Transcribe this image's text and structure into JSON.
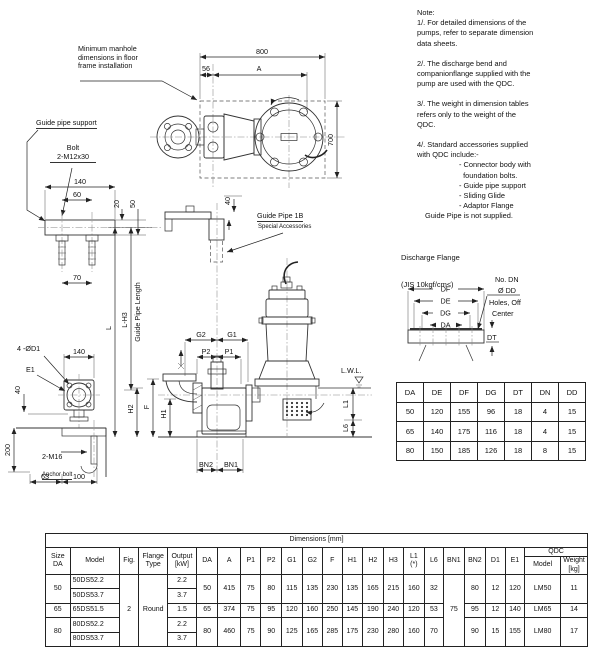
{
  "notes": {
    "items": [
      "Note:",
      "1/. For detailed dimensions of the\npumps, refer to separate dimension\ndata sheets.",
      "2/. The discharge bend and\ncompanionflange supplied with the\npump are used with the QDC.",
      "3/. The weight in dimension tables\nrefers only to the weight of the\nQDC.",
      "4/. Standard accessories supplied\nwith QDC include:-",
      "- Connector body with\n  foundation bolts.",
      "- Guide pipe support",
      "- Sliding Glide",
      "- Adaptor Flange",
      "Guide Pipe is not supplied."
    ]
  },
  "drawing": {
    "manhole_note": "Minimum manhole\ndimensions in floor\nframe installation",
    "guide_pipe_support": "Guide pipe support",
    "bolt": "Bolt\n2-M12x30",
    "gp1b": "Guide Pipe 1B",
    "special_acc": "Special Accessories",
    "d800": "800",
    "d56": "56",
    "dA": "A",
    "d700": "700",
    "d140_support": "140",
    "d60": "60",
    "d70": "70",
    "d20": "20",
    "d50": "50",
    "d40_pipe": "40",
    "L": "L",
    "LH3": "L-H3",
    "gpl": "Guide Pipe Length",
    "four_od1": "4 -ØD1",
    "e1": "E1",
    "d140_plate": "140",
    "d40_plate": "40",
    "d200": "200",
    "m16": "2-M16",
    "anchor_bolt": "Anchor bolt",
    "d63": "63",
    "d100": "100",
    "h2": "H2",
    "f": "F",
    "h1": "H1",
    "g2": "G2",
    "g1": "G1",
    "p2": "P2",
    "p1": "P1",
    "bn2": "BN2",
    "bn1": "BN1",
    "lwl": "L.W.L.",
    "l1": "L1",
    "l6": "L6"
  },
  "flange": {
    "title": "Discharge Flange",
    "subtitle": "(JIS 10kgf/cm≤)",
    "df": "DF",
    "de": "DE",
    "dg": "DG",
    "da": "DA",
    "dt": "DT",
    "hole_note_1": "No. DN",
    "hole_note_2": "Ø DD",
    "hole_note_3": "Holes, Off",
    "hole_note_4": "Center"
  },
  "flange_table": {
    "headers": [
      "DA",
      "DE",
      "DF",
      "DG",
      "DT",
      "DN",
      "DD"
    ],
    "rows": [
      [
        "50",
        "120",
        "155",
        "96",
        "18",
        "4",
        "15"
      ],
      [
        "65",
        "140",
        "175",
        "116",
        "18",
        "4",
        "15"
      ],
      [
        "80",
        "150",
        "185",
        "126",
        "18",
        "8",
        "15"
      ]
    ]
  },
  "main_table": {
    "title": "Dimensions [mm]",
    "col_headers": [
      "Size\nDA",
      "Model",
      "Fig.",
      "Flange\nType",
      "Output\n[kW]",
      "DA",
      "A",
      "P1",
      "P2",
      "G1",
      "G2",
      "F",
      "H1",
      "H2",
      "H3",
      "L1\n(*)",
      "L6",
      "BN1",
      "BN2",
      "D1",
      "E1"
    ],
    "qdc_label": "QDC",
    "qdc_model_header": "Model",
    "qdc_weight_header": "Weight\n[kg]",
    "fig": "2",
    "flange_type": "Round",
    "bn1": "75",
    "groups": [
      {
        "size": "50",
        "models": [
          {
            "name": "50DS52.2",
            "output": "2.2"
          },
          {
            "name": "50DS53.7",
            "output": "3.7"
          }
        ],
        "dims": [
          "50",
          "415",
          "75",
          "80",
          "115",
          "135",
          "230",
          "135",
          "165",
          "215",
          "160",
          "32"
        ],
        "bn2": "80",
        "d1": "12",
        "e1": "120",
        "qdc_model": "LM50",
        "weight": "11"
      },
      {
        "size": "65",
        "models": [
          {
            "name": "65DS51.5",
            "output": "1.5"
          }
        ],
        "dims": [
          "65",
          "374",
          "75",
          "95",
          "120",
          "160",
          "250",
          "145",
          "190",
          "240",
          "120",
          "53"
        ],
        "bn2": "95",
        "d1": "12",
        "e1": "140",
        "qdc_model": "LM65",
        "weight": "14"
      },
      {
        "size": "80",
        "models": [
          {
            "name": "80DS52.2",
            "output": "2.2"
          },
          {
            "name": "80DS53.7",
            "output": "3.7"
          }
        ],
        "dims": [
          "80",
          "460",
          "75",
          "90",
          "125",
          "165",
          "285",
          "175",
          "230",
          "280",
          "160",
          "70"
        ],
        "bn2": "90",
        "d1": "15",
        "e1": "155",
        "qdc_model": "LM80",
        "weight": "17"
      }
    ]
  }
}
